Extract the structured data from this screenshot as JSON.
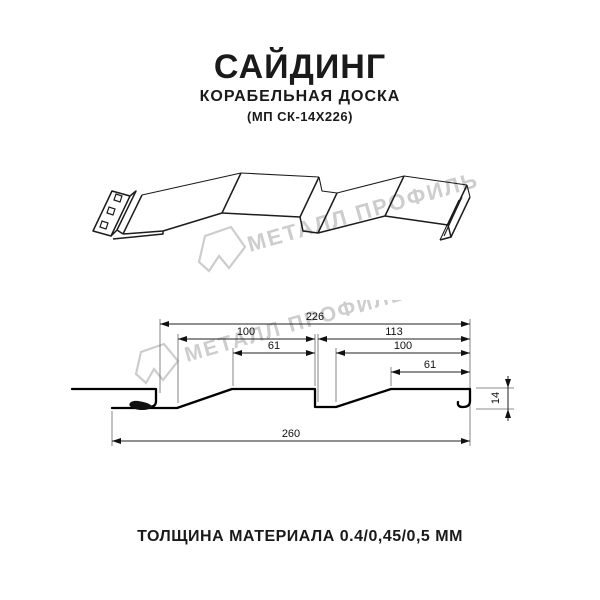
{
  "header": {
    "title": "САЙДИНГ",
    "subtitle": "КОРАБЕЛЬНАЯ ДОСКА",
    "model": "(МП СК-14Х226)"
  },
  "watermark": {
    "text": "МЕТАЛЛ ПРОФИЛЬ",
    "color": "#cdcdcd"
  },
  "cross_section": {
    "dim_total": "226",
    "dim_left_pitch": "100",
    "dim_right_span": "113",
    "dim_left_flat": "61",
    "dim_right_pitch": "100",
    "dim_right_flat": "61",
    "dim_overall": "260",
    "dim_height": "14"
  },
  "footer": {
    "material": "ТОЛЩИНА МАТЕРИАЛА 0.4/0,45/0,5 ММ"
  }
}
